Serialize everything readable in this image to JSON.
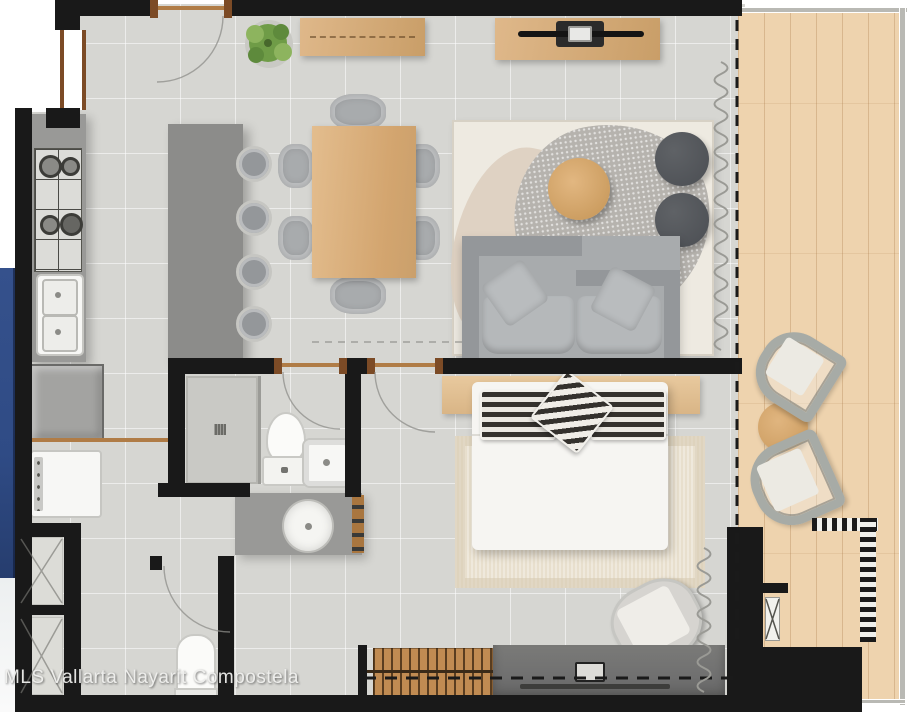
{
  "watermark": {
    "text": "MLS Vallarta Nayarit Compostela"
  },
  "palette": {
    "outside": "#ffffff",
    "wall": "#191919",
    "floor": "#d6d6d2",
    "blue": "#2f4b85",
    "balconyWood": "#eed3ae",
    "railing": "#b9b9b4",
    "wood": "#dfb88a",
    "woodDark": "#c99e68",
    "doorWood": "#7c4b26",
    "threshold": "#b07c46",
    "counter": "#999997",
    "island": "#8c8c8a",
    "appliance": "#a3a3a1",
    "fixture": "#f7f7f5",
    "glass": "#9b9b97",
    "sofa": "#a8abad",
    "sofaDark": "#94979a",
    "sofaLight": "#b5b8ba",
    "rugCream": "#eeeae1",
    "rugBeige": "#ddcfc0",
    "rugGray": "#b6b3ae",
    "ottoman": "#4b4e53",
    "bed": "#f6f5f2",
    "bedroomRug": "#e8dfcd",
    "dresser": "#707070",
    "bench": "#c08b52",
    "stripeDark": "#34312d",
    "chrome": "#c6c6c2",
    "curtain": "#9a9a95",
    "dash": "#1a1a1a",
    "arcLine": "#8e8e89",
    "plantGreen": "#6f9c47",
    "plantGreenLight": "#8db45e",
    "watermark": "#efefed"
  }
}
